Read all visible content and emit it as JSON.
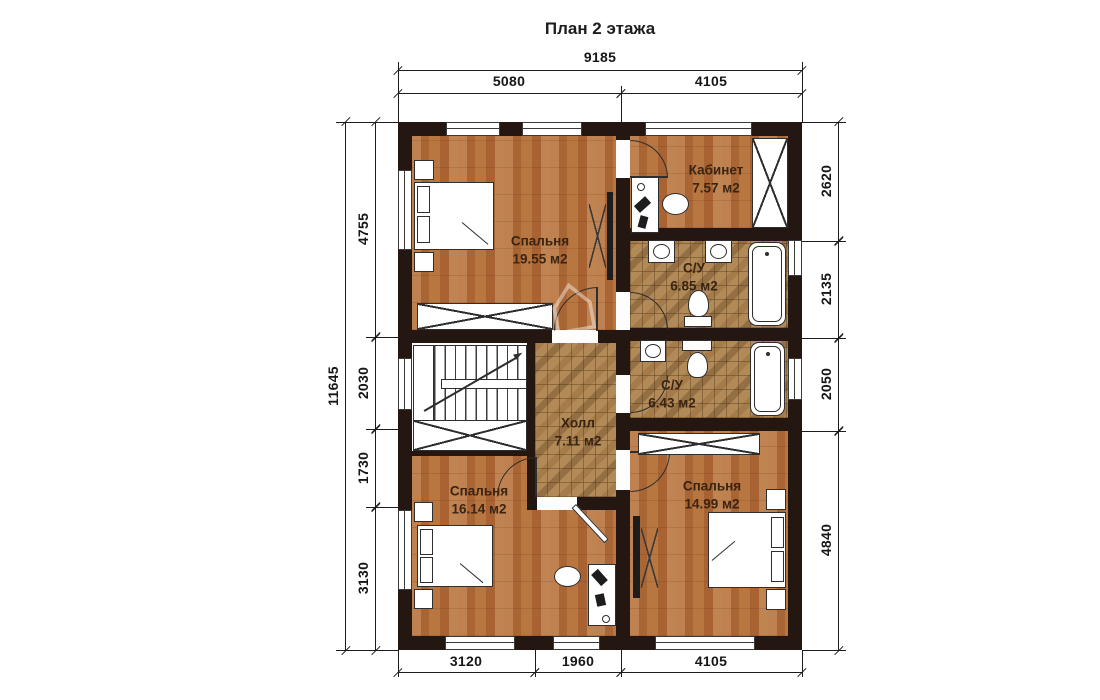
{
  "title": "План 2 этажа",
  "floor_plan": {
    "rooms": [
      {
        "id": "bedroom-top",
        "name": "Спальня",
        "area": "19.55 м2"
      },
      {
        "id": "office",
        "name": "Кабинет",
        "area": "7.57 м2"
      },
      {
        "id": "bathroom-1",
        "name": "С/У",
        "area": "6.85 м2"
      },
      {
        "id": "hall",
        "name": "Холл",
        "area": "7.11 м2"
      },
      {
        "id": "bathroom-2",
        "name": "С/У",
        "area": "6.43 м2"
      },
      {
        "id": "bedroom-left",
        "name": "Спальня",
        "area": "16.14 м2"
      },
      {
        "id": "bedroom-right",
        "name": "Спальня",
        "area": "14.99 м2"
      }
    ],
    "dimensions": {
      "top": {
        "total": "9185",
        "segments": [
          "5080",
          "4105"
        ]
      },
      "bottom": {
        "segments": [
          "3120",
          "1960",
          "4105"
        ]
      },
      "left": {
        "total": "11645",
        "segments": [
          "4755",
          "2030",
          "1730",
          "3130"
        ]
      },
      "right": {
        "segments": [
          "2620",
          "2135",
          "2050",
          "4840"
        ]
      }
    },
    "watermark_icon": "⌂",
    "colors": {
      "wall": "#241712",
      "wood_floor": "#b5723f",
      "tile_floor": "#b18a58",
      "background": "#ffffff"
    }
  }
}
